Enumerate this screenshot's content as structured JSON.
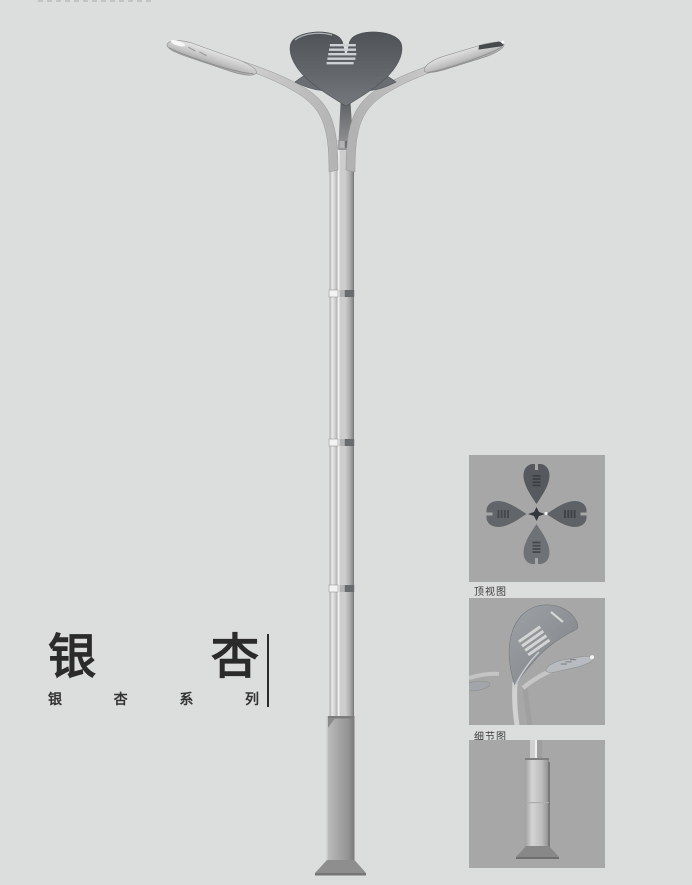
{
  "colors": {
    "bg": "#dcdddd",
    "panel-bg": "#a7a7a7",
    "leaf-dark": "#575b5f",
    "metal-light": "#e8e8e8",
    "metal-mid": "#b4b4b4",
    "metal-dark": "#8a8a8a",
    "text-dark": "#2b2b2b",
    "label-text": "#3b3b3b"
  },
  "brand": {
    "title_char_1": "银",
    "title_char_2": "杏",
    "series_char_1": "银",
    "series_char_2": "杏",
    "series_char_3": "系",
    "series_char_4": "列"
  },
  "panels": {
    "top_view_label": "顶视图",
    "detail_view_label": "细节图"
  }
}
